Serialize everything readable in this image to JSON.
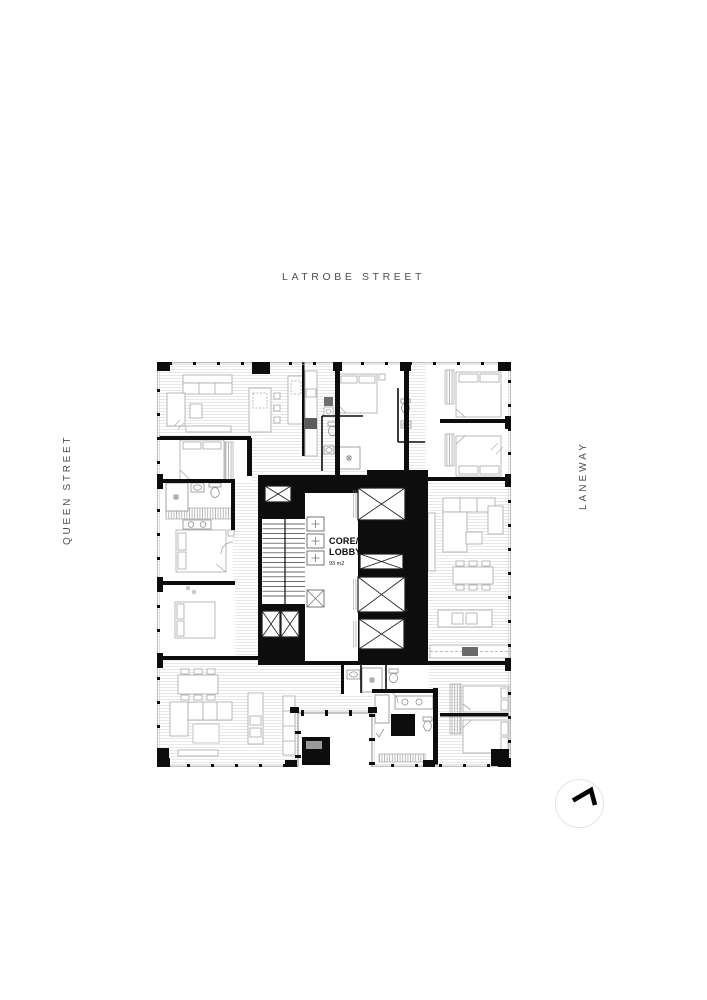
{
  "page": {
    "background": "#ffffff",
    "kind": "architectural floor plan"
  },
  "streets": {
    "top": "LATROBE STREET",
    "left": "QUEEN STREET",
    "right": "LANEWAY"
  },
  "core": {
    "line1": "CORE/",
    "line2": "LOBBY",
    "area": "93 m2"
  },
  "icons": {
    "north_arrow": "north-arrow-icon"
  },
  "colors": {
    "wall_black": "#0d0d0d",
    "street_text": "#4d4f52",
    "floor_line": "#dedede",
    "furniture_line": "#a8a8a8",
    "glazing_line": "#8a8a8a",
    "north_circle_border": "#e4e4e4"
  }
}
